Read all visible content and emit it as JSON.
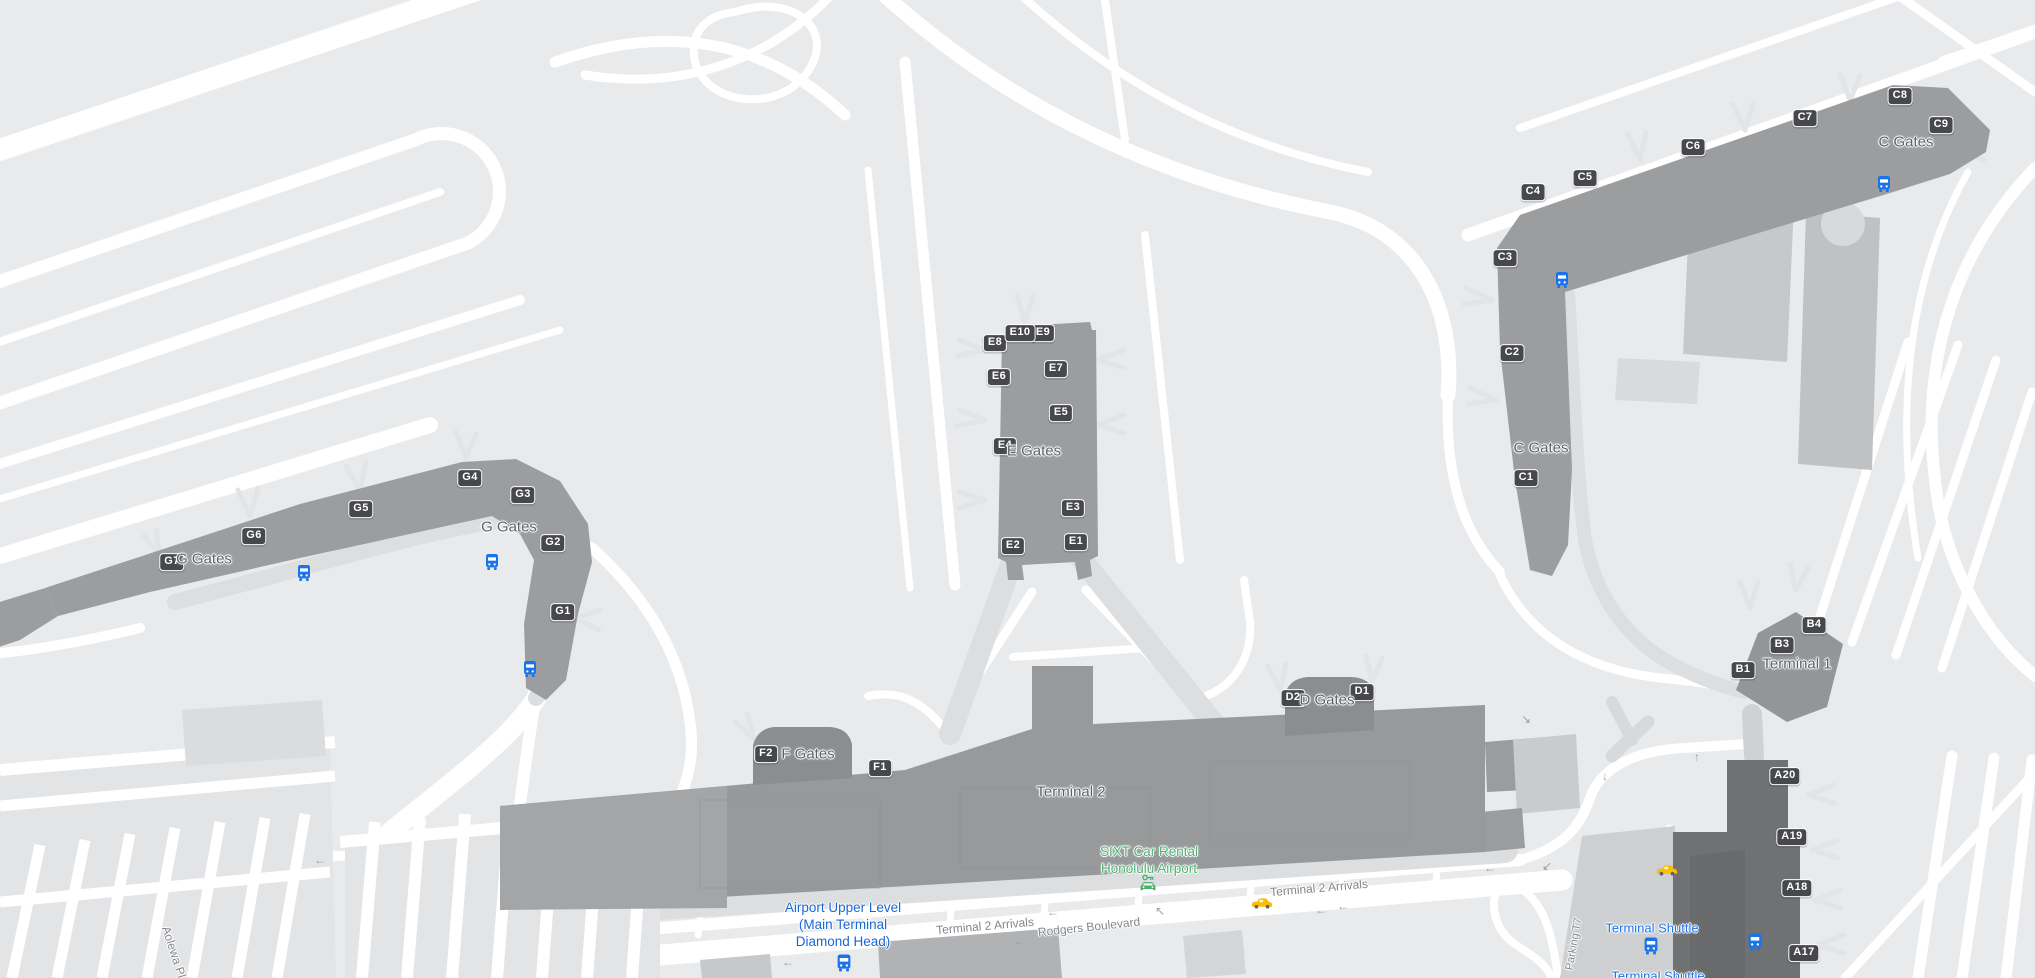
{
  "colors": {
    "background": "#e9eaec",
    "road_white": "#ffffff",
    "curb_gray": "#dcdee0",
    "pier_gray": "#9b9d9f",
    "terminal_gray": "#97999b",
    "terminal_dark": "#6f7173",
    "badge_bg": "#47484b",
    "transit_blue": "#1a73e8",
    "upper_level_blue": "#1967d2",
    "poi_green": "#4db16e",
    "traffic_yellow": "#fbbc04",
    "arrow_gray": "#9aa0a6"
  },
  "terminals": {
    "t1": "Terminal 1",
    "t2": "Terminal 2"
  },
  "gate_areas": {
    "c": "C Gates",
    "d": "D Gates",
    "e": "E Gates",
    "f": "F Gates",
    "g": "G Gates"
  },
  "gates": {
    "a": [
      "A17",
      "A18",
      "A19",
      "A20"
    ],
    "b": [
      "B1",
      "B3",
      "B4"
    ],
    "c": [
      "C1",
      "C2",
      "C3",
      "C4",
      "C5",
      "C6",
      "C7",
      "C8",
      "C9"
    ],
    "d": [
      "D1",
      "D2"
    ],
    "e": [
      "E1",
      "E2",
      "E3",
      "E4",
      "E5",
      "E6",
      "E7",
      "E8",
      "E9",
      "E10"
    ],
    "f": [
      "F1",
      "F2"
    ],
    "g": [
      "G1",
      "G2",
      "G3",
      "G4",
      "G5",
      "G6",
      "G7"
    ]
  },
  "roads": {
    "rodgers": "Rodgers Boulevard",
    "t2_arrivals": "Terminal 2 Arrivals",
    "aolewa": "Aolewa Pl",
    "parking_t7": "Parking T7"
  },
  "transit": {
    "upper_level_line1": "Airport Upper Level",
    "upper_level_line2": "(Main Terminal",
    "upper_level_line3": "Diamond Head)",
    "terminal_shuttle": "Terminal Shuttle"
  },
  "poi": {
    "sixt_line1": "SIXT Car Rental",
    "sixt_line2": "Honolulu Airport"
  },
  "arrow_glyphs": {
    "left": "←",
    "up": "↑",
    "down": "↓",
    "up_left": "↖",
    "down_right": "↘",
    "down_left": "↙"
  }
}
